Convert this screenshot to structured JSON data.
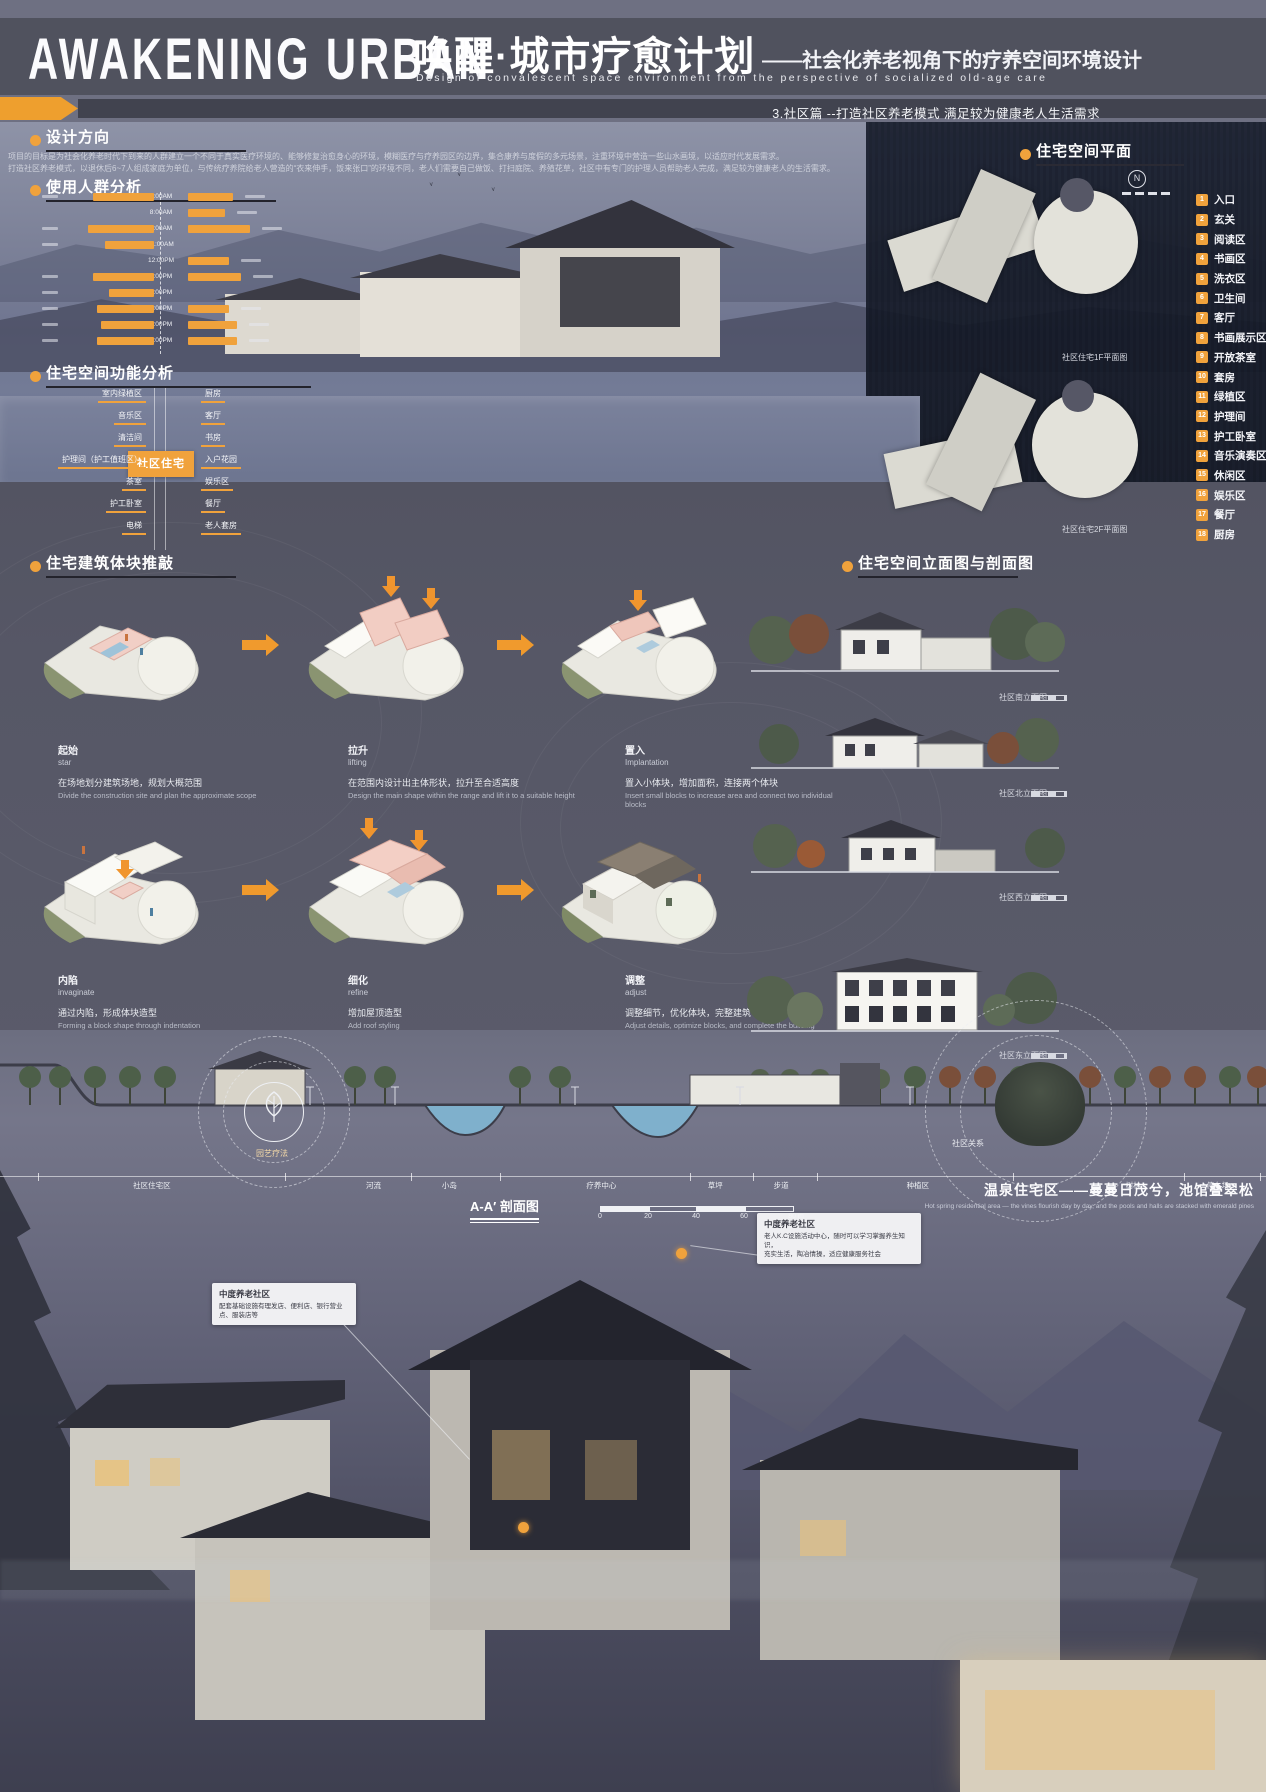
{
  "header": {
    "title_en": "AWAKENING URBAN",
    "title_zh": "唤醒·城市疗愈计划",
    "subtitle_zh": "——社会化养老视角下的疗养空间环境设计",
    "subtitle_en": "Design of convalescent space environment from the perspective of socialized old-age care",
    "section_tag": "3.社区篇 --打造社区养老模式 满足较为健康老人生活需求"
  },
  "design_direction": {
    "title": "设计方向",
    "body": [
      "项目的目标是为社会化养老时代下到来的人群建立一个不同于真实医疗环境的、能够修复治愈身心的环境，模糊医疗与疗养园区的边界，集合康养与度假的多元场景，注重环境中营造一些山水画境，以适应时代发展需求。",
      "打造社区养老模式，以退休后6~7人组成家庭为单位，与传统疗养院给老人营造的“衣来伸手，饭来张口”的环境不同，老人们需要自己做饭、打扫庭院、养殖花草，社区中有专门的护理人员帮助老人完成，满足较为健康老人的生活需求。"
    ]
  },
  "user_analysis": {
    "title": "使用人群分析"
  },
  "function_analysis": {
    "title": "住宅空间功能分析",
    "center": "社区住宅",
    "left": [
      "室内绿植区",
      "音乐区",
      "清洁间",
      "护理间（护工值班区）",
      "茶室",
      "护工卧室",
      "电梯"
    ],
    "right": [
      "厨房",
      "客厅",
      "书房",
      "入户花园",
      "娱乐区",
      "餐厅",
      "老人套房"
    ]
  },
  "plan": {
    "title": "住宅空间平面",
    "captions": [
      "社区住宅1F平面图",
      "社区住宅2F平面图"
    ],
    "legend": [
      {
        "num": "1",
        "label": "入口"
      },
      {
        "num": "2",
        "label": "玄关"
      },
      {
        "num": "3",
        "label": "阅读区"
      },
      {
        "num": "4",
        "label": "书画区"
      },
      {
        "num": "5",
        "label": "洗衣区"
      },
      {
        "num": "6",
        "label": "卫生间"
      },
      {
        "num": "7",
        "label": "客厅"
      },
      {
        "num": "8",
        "label": "书画展示区"
      },
      {
        "num": "9",
        "label": "开放茶室"
      },
      {
        "num": "10",
        "label": "套房"
      },
      {
        "num": "11",
        "label": "绿植区"
      },
      {
        "num": "12",
        "label": "护理间"
      },
      {
        "num": "13",
        "label": "护工卧室"
      },
      {
        "num": "14",
        "label": "音乐演奏区"
      },
      {
        "num": "15",
        "label": "休闲区"
      },
      {
        "num": "16",
        "label": "娱乐区"
      },
      {
        "num": "17",
        "label": "餐厅"
      },
      {
        "num": "18",
        "label": "厨房"
      }
    ]
  },
  "massing": {
    "title": "住宅建筑体块推敲",
    "steps": [
      {
        "name_zh": "起始",
        "name_en": "star",
        "desc_zh": "在场地划分建筑场地，规划大概范围",
        "desc_en": "Divide the construction site and plan the approximate scope"
      },
      {
        "name_zh": "拉升",
        "name_en": "lifting",
        "desc_zh": "在范围内设计出主体形状，拉升至合适高度",
        "desc_en": "Design the main shape within the range and lift it to a suitable height"
      },
      {
        "name_zh": "置入",
        "name_en": "Implantation",
        "desc_zh": "置入小体块，增加面积，连接两个体块",
        "desc_en": "Insert small blocks to increase area and connect two individual blocks"
      },
      {
        "name_zh": "内陷",
        "name_en": "invaginate",
        "desc_zh": "通过内陷，形成体块造型",
        "desc_en": "Forming a block shape through indentation"
      },
      {
        "name_zh": "细化",
        "name_en": "refine",
        "desc_zh": "增加屋顶造型",
        "desc_en": "Add roof styling"
      },
      {
        "name_zh": "调整",
        "name_en": "adjust",
        "desc_zh": "调整细节，优化体块，完整建筑",
        "desc_en": "Adjust details, optimize blocks, and complete the building"
      }
    ]
  },
  "elevations": {
    "title": "住宅空间立面图与剖面图",
    "captions": [
      "社区南立面图",
      "社区北立面图",
      "社区西立面图",
      "社区东立面图"
    ]
  },
  "section_aa": {
    "title": "A-A′ 剖面图",
    "zones": [
      "社区住宅区",
      "河流",
      "小岛",
      "疗养中心",
      "草坪",
      "步道",
      "种植区",
      "树林",
      "停车场"
    ],
    "scale": [
      "0",
      "20",
      "40",
      "60",
      "80 m"
    ]
  },
  "bottom": {
    "emblem_label": "园艺疗法",
    "circle_label": "社区关系",
    "title_zh": "温泉住宅区——蔓蔓日茂兮，池馆叠翠松",
    "title_en": "Hot spring residential area — the vines flourish day by day, and the pools and halls are stacked with emerald pines",
    "callouts": [
      {
        "title": "中度养老社区",
        "line1": "老人K.C设施活动中心，随时可以学习掌握养生知识，",
        "line2": "充实生活，陶冶情操，适应健康服务社会"
      },
      {
        "title": "中度养老社区",
        "line1": "配套基础设施有理发店、便利店、银行营业点、服装店等",
        "line2": ""
      }
    ]
  },
  "colors": {
    "accent": "#f0a23c",
    "pink_block": "#f2cdc3",
    "panel": "#565766"
  },
  "chart_data": {
    "type": "bar",
    "title": "使用人群分析",
    "orientation": "horizontal bars mirrored around a central daily time axis",
    "time_axis": [
      "7:00AM",
      "8:00AM",
      "9:00AM",
      "11:00AM",
      "12:00PM",
      "2:00PM",
      "4:00PM",
      "6:00PM",
      "7:00PM",
      "9:00PM"
    ],
    "series": [
      {
        "name": "左侧人群活动时长(估)",
        "values": [
          0.75,
          0,
          0.8,
          0.6,
          0,
          0.75,
          0.55,
          0.7,
          0.65,
          0.7
        ]
      },
      {
        "name": "右侧人群活动时长(估)",
        "values": [
          0.55,
          0.45,
          0.75,
          0,
          0.5,
          0.65,
          0,
          0.5,
          0.6,
          0.6
        ]
      }
    ],
    "legend_position": "none",
    "grid": false
  }
}
